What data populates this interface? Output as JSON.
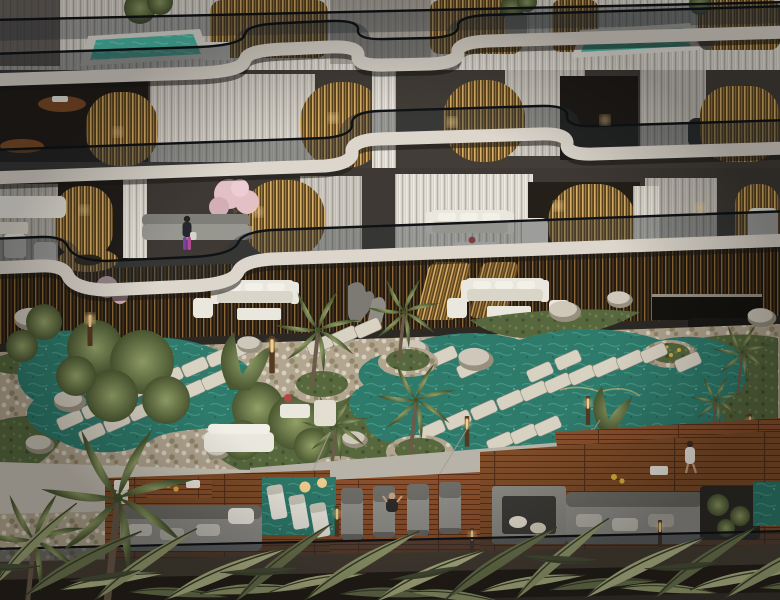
{
  "scene": {
    "title": "aerial-residence-render",
    "setting": "Aerial dusk view of a luxury residential building: curved white balcony slabs with glass railings, brass vertical slat screens, sheer curtains, rooftop plunge pools, and a resort-style lagoon garden deck with stepping stones, boulders, palms, lounge furniture and a timber pool deck",
    "objects": {
      "plunge_pools": 2,
      "lagoon_pools": 2,
      "stepping_stones": 35,
      "people": [
        "woman-on-balcony",
        "person-in-robe-walking",
        "person-seated-on-deck"
      ],
      "trees": [
        "olive-trees",
        "palm-trees",
        "pink-blossom-tree"
      ],
      "furniture": [
        "white-sofa-sets",
        "grey-sectional-sofas",
        "sun-loungers",
        "in-water-loungers",
        "fire-pit",
        "timber-tables"
      ]
    },
    "palette": {
      "facade": "#3a3632",
      "facadeDeep": "#262220",
      "interiorDark": "#211d1a",
      "slab": "#dcd6cc",
      "slabShadow": "#9a948a",
      "slabDark": "#1c1916",
      "curtain": "#d8d3ca",
      "curtainLight": "#efebe3",
      "curtainShade": "#b5b0a7",
      "goldBase": "#5c441f",
      "goldLight": "#d9b069",
      "goldMid": "#a87c3c",
      "bronzeBase": "#221a10",
      "bronzeLine": "#8a6636",
      "glass": "#2b3238",
      "rail": "#101316",
      "poolBright": "#4ec3af",
      "poolLine": "#93e4d3",
      "lagoon": "#2e7a6b",
      "lagoonLine": "#56ab97",
      "stone": "#d8d2c3",
      "pebble": "#b3a691",
      "pebbleLight": "#d7cfbc",
      "pebbleDark": "#938769",
      "grass": "#57683e",
      "grassLight": "#6e814c",
      "grassDark": "#42522e",
      "canopyLight": "#93a067",
      "canopyDark": "#4a5731",
      "rock": "#cfc8ba",
      "rockShade": "#97907f",
      "wood": "#7e4c29",
      "woodDark": "#53301a",
      "woodRed": "#8a4f2c",
      "trunk": "#6b5b49",
      "sofaGrey": "#908f8a",
      "sofaGreyDark": "#5b5952",
      "white": "#eae7de",
      "blossom": "#e3bfc6",
      "frond": "#9aa272",
      "frondDark": "#6e7750",
      "frondLight": "#b8bc8a",
      "frondDim": "#4c523a",
      "amber": "#f2cf8e",
      "skin": "#caa183",
      "purple": "#7b3fa6",
      "magenta": "#b44a96",
      "concrete": "#b8b3a8",
      "sand": "#c9c3b6",
      "fireStone": "#8c8a83",
      "flowerYellow": "#d8b13c",
      "flowerRed": "#b4464a"
    }
  }
}
